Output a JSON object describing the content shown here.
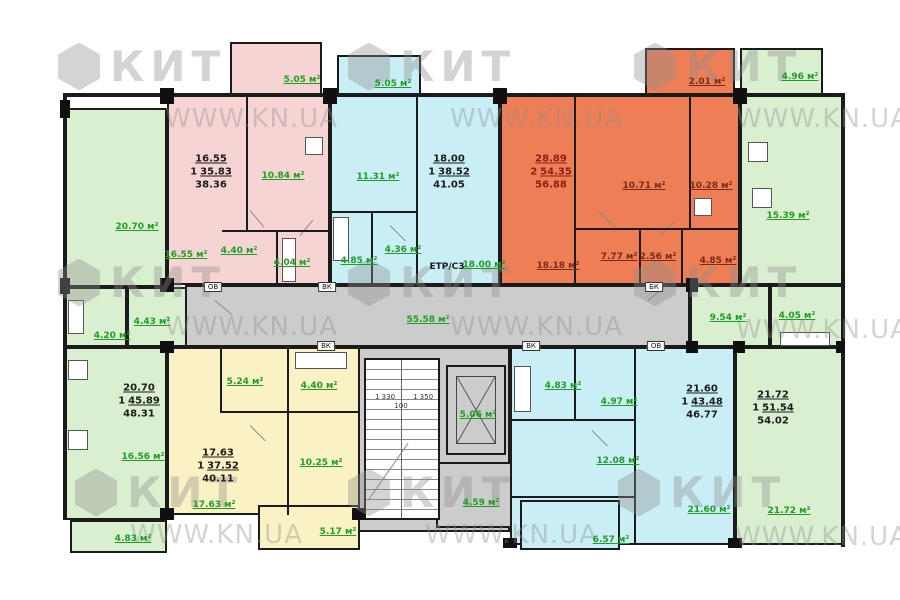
{
  "colors": {
    "pink": "#f7d4d4",
    "cyan": "#c9eef5",
    "orange": "#ee7e56",
    "green": "#d9efcf",
    "yellow": "#faf2c4",
    "gray": "#cccccc",
    "wall": "#1b1b1b",
    "label-green": "#1e9e24",
    "label-dark": "#7d2b18",
    "summary-dark": "#8c1f14",
    "wm": "#8f8f8f"
  },
  "watermark": {
    "logo": "КИТ",
    "url": "WWW.KN.UA"
  },
  "tags": {
    "ov": "ОВ",
    "vk": "ВК",
    "bk": "БК"
  },
  "stairs": {
    "dim_left": "1 330",
    "dim_mid": "100",
    "dim_right": "1 350"
  },
  "common": {
    "corridor": "55.58 м²",
    "elevator": "5.06 м²",
    "utility": "4.59 м²",
    "etr": "ЕТР/С3"
  },
  "apartments": {
    "left_green": {
      "summary": {
        "living": "20.70",
        "rooms": "1",
        "living_total": "45.89",
        "total": "48.31"
      },
      "labels": {
        "living": "20.70 м²",
        "kitchen": "16.56 м²",
        "hall": "4.43 м²",
        "bath": "4.20 м²",
        "balcony": "4.83 м²"
      }
    },
    "pink": {
      "summary": {
        "living": "16.55",
        "rooms": "1",
        "living_total": "35.83",
        "total": "38.36"
      },
      "labels": {
        "living": "16.55 м²",
        "kitchen": "10.84 м²",
        "hall": "4.40 м²",
        "bath": "4.04 м²",
        "balcony": "5.05 м²"
      }
    },
    "cyan_top": {
      "summary": {
        "living": "18.00",
        "rooms": "1",
        "living_total": "38.52",
        "total": "41.05"
      },
      "labels": {
        "living": "18.00 м²",
        "kitchen": "11.31 м²",
        "hall": "4.36 м²",
        "bath": "4.85 м²",
        "balcony": "5.05 м²"
      }
    },
    "orange": {
      "summary": {
        "living": "28.89",
        "rooms": "2",
        "living_total": "54.35",
        "total": "56.88"
      },
      "labels": {
        "living": "18.18 м²",
        "bedroom": "10.71 м²",
        "kitchen": "10.28 м²",
        "hall": "7.77 м²",
        "bath": "2.56 м²",
        "corridor": "4.85 м²",
        "balcony": "2.01 м²"
      }
    },
    "right_green": {
      "summary": {
        "living": "21.72",
        "rooms": "1",
        "living_total": "51.54",
        "total": "54.02"
      },
      "labels": {
        "living": "21.72 м²",
        "kitchen": "15.39 м²",
        "hall": "9.54 м²",
        "bath": "4.05 м²",
        "balcony": "4.96 м²"
      }
    },
    "yellow": {
      "summary": {
        "living": "17.63",
        "rooms": "1",
        "living_total": "37.52",
        "total": "40.11"
      },
      "labels": {
        "living": "17.63 м²",
        "kitchen": "10.25 м²",
        "hall": "5.24 м²",
        "bath": "4.40 м²",
        "balcony": "5.17 м²"
      }
    },
    "cyan_bottom": {
      "summary": {
        "living": "21.60",
        "rooms": "1",
        "living_total": "43.48",
        "total": "46.77"
      },
      "labels": {
        "living": "21.60 м²",
        "kitchen": "12.08 м²",
        "hall": "4.97 м²",
        "bath": "4.83 м²",
        "balcony": "6.57 м²"
      }
    }
  }
}
